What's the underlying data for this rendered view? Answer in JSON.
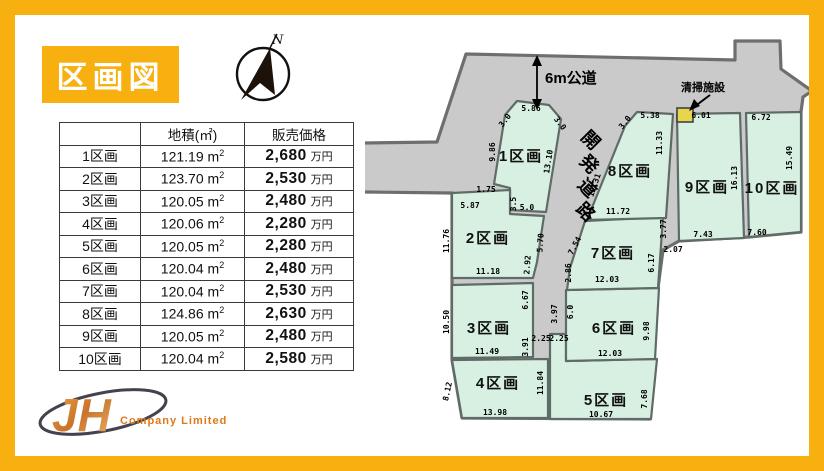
{
  "title": "区画図",
  "compass": {
    "label": "N"
  },
  "table": {
    "headers": {
      "col2": "地積(㎡)",
      "col3": "販売価格"
    },
    "units": {
      "area_base": "m",
      "area_sup": "2",
      "price": "万円"
    },
    "rows": [
      {
        "label": "1区画",
        "area": "121.19",
        "price": "2,680"
      },
      {
        "label": "2区画",
        "area": "123.70",
        "price": "2,530"
      },
      {
        "label": "3区画",
        "area": "120.05",
        "price": "2,480"
      },
      {
        "label": "4区画",
        "area": "120.06",
        "price": "2,280"
      },
      {
        "label": "5区画",
        "area": "120.05",
        "price": "2,280"
      },
      {
        "label": "6区画",
        "area": "120.04",
        "price": "2,480"
      },
      {
        "label": "7区画",
        "area": "120.04",
        "price": "2,530"
      },
      {
        "label": "8区画",
        "area": "124.86",
        "price": "2,630"
      },
      {
        "label": "9区画",
        "area": "120.05",
        "price": "2,480"
      },
      {
        "label": "10区画",
        "area": "120.04",
        "price": "2,580"
      }
    ]
  },
  "map": {
    "road_label": "6m公道",
    "dev_road_label": "開発道路",
    "facility_label": "清掃施設",
    "plot_labels": [
      "1区画",
      "2区画",
      "3区画",
      "4区画",
      "5区画",
      "6区画",
      "7区画",
      "8区画",
      "9区画",
      "10区画"
    ],
    "dims": [
      "5.86",
      "3.0",
      "3.0",
      "9.86",
      "13.10",
      "1.75",
      "3.5",
      "5.0",
      "5.87",
      "11.76",
      "5.70",
      "2.92",
      "11.18",
      "6.67",
      "10.50",
      "3.91",
      "11.49",
      "3.97",
      "2.25",
      "2.25",
      "8.12",
      "11.84",
      "13.98",
      "10.67",
      "7.68",
      "6.0",
      "9.98",
      "12.03",
      "11.72",
      "7.54",
      "2.86",
      "12.03",
      "6.17",
      "3.77",
      "2.07",
      "5.38",
      "3.0",
      "11.33",
      "12.31",
      "6.01",
      "16.13",
      "7.43",
      "6.72",
      "15.49",
      "7.60"
    ]
  },
  "logo": {
    "mark": "JH",
    "text": "Company Limited"
  },
  "colors": {
    "accent": "#f7b010",
    "plot_green": "#d8f0e2",
    "road_gray": "#cacaca",
    "facility_yellow": "#e7d54d"
  }
}
